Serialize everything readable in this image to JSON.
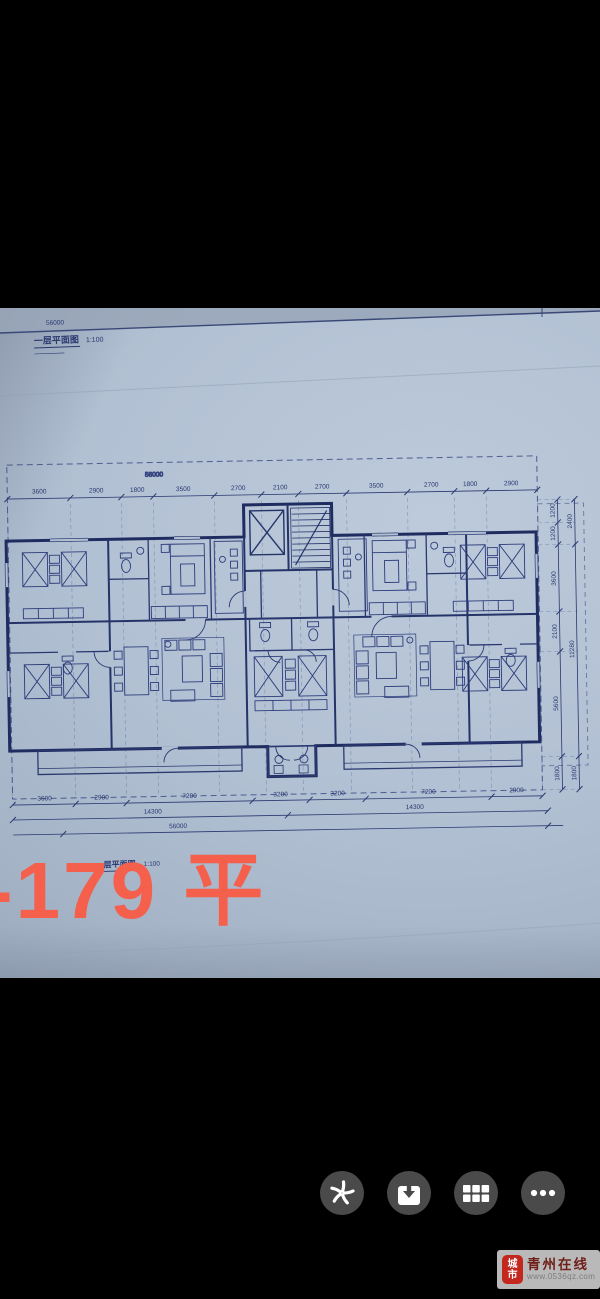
{
  "photo": {
    "sheet": {
      "title": "一层平面图",
      "scale": "1:100",
      "overall_width_label": "56000"
    },
    "second_sheet": {
      "title_fragment": "层平面图",
      "scale": "1:100"
    },
    "dims": {
      "top_total": "56000",
      "top": [
        "3600",
        "2900",
        "1800",
        "3500",
        "2700",
        "2100",
        "2700",
        "3500",
        "2700",
        "1800",
        "2900"
      ],
      "bottom_row1": [
        "3600",
        "2900",
        "7200",
        "3200",
        "3200",
        "7200",
        "2900"
      ],
      "bottom_row2": [
        "14300",
        "14300"
      ],
      "bottom_total": "56000",
      "right_inner": [
        "1200",
        "1200",
        "3600",
        "2100",
        "5600",
        "1800"
      ],
      "right_outer": [
        "2400",
        "11280",
        "1800"
      ]
    }
  },
  "overlay": {
    "area_label": "-179 平",
    "color": "#f4604c"
  },
  "toolbar": {
    "buttons": [
      {
        "icon": "spark-share-icon"
      },
      {
        "icon": "download-icon"
      },
      {
        "icon": "grid-apps-icon"
      },
      {
        "icon": "more-icon"
      }
    ],
    "button_bg": "#4a4a4a"
  },
  "watermark": {
    "seal_top": "城",
    "seal_bottom": "市",
    "site_name": "青州在线",
    "site_url": "www.0536qz.com"
  },
  "colors": {
    "paper": "#aebccf",
    "ink": "#243468",
    "accent_red": "#f4604c"
  }
}
